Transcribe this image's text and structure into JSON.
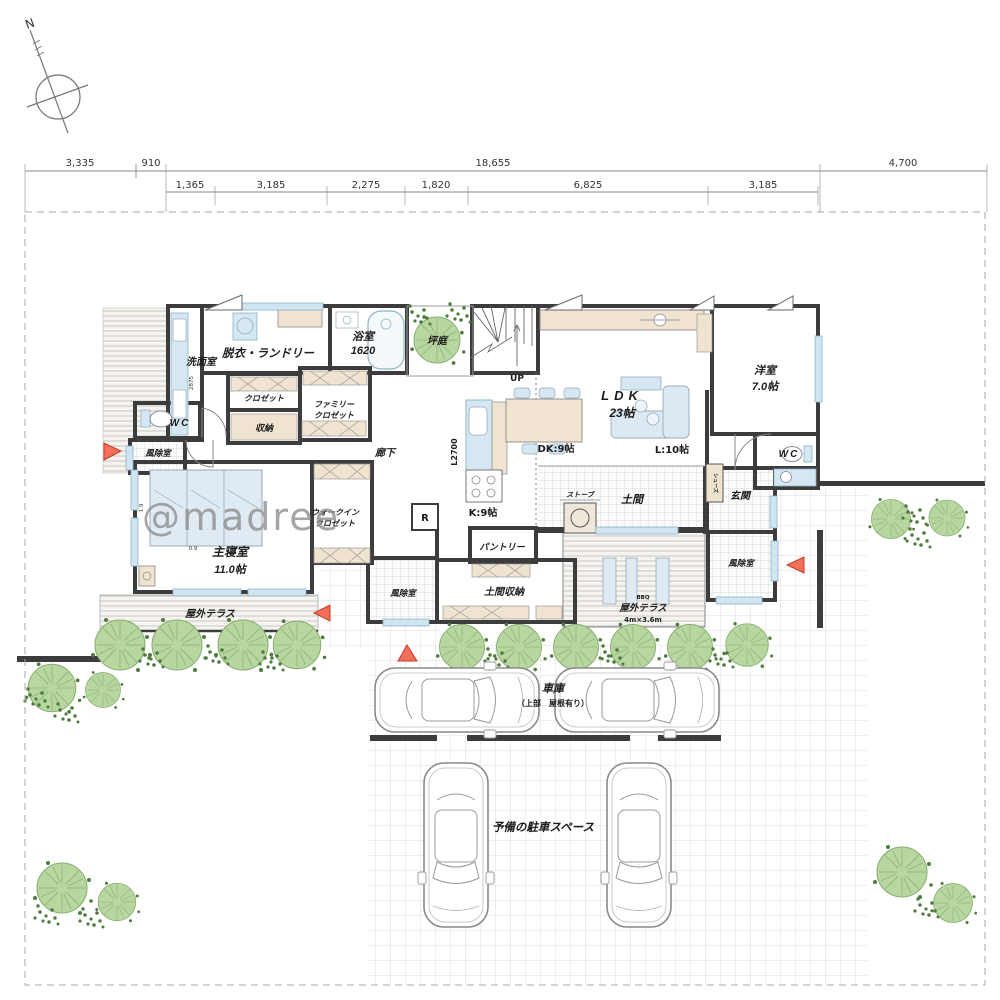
{
  "site": {
    "compass": "N",
    "watermark": "@madree",
    "dim_top": [
      "3,335",
      "910",
      "18,655",
      "4,700"
    ],
    "dim_second": [
      "1,365",
      "3,185",
      "2,275",
      "1,820",
      "6,825",
      "3,185"
    ]
  },
  "rooms": {
    "washroom": "洗面室",
    "laundry": "脱衣・ランドリー",
    "bath": "浴室",
    "bath_size": "1620",
    "courtyard": "坪庭",
    "closet": "クロゼット",
    "family_closet_1": "ファミリー",
    "storage": "収納",
    "wc": "WC",
    "windbreak": "風除室",
    "corridor": "廊下",
    "master": "主寝室",
    "master_size": "11.0帖",
    "bed_w": "1.9",
    "bed_d": "0.9",
    "wash_dim": "2875",
    "wic_1": "ウォークイン",
    "up": "UP",
    "ldk": "LDK",
    "ldk_size": "23帖",
    "dk": "DK:9帖",
    "living": "L:10帖",
    "kitchen": "K:9帖",
    "kitchen_counter": "L2700",
    "fridge": "R",
    "western": "洋室",
    "western_size": "7.0帖",
    "genkan": "玄関",
    "shoes": "シューズ",
    "doma": "土間",
    "stove": "ストーブ",
    "doma_storage": "土間収納",
    "pantry": "パントリー",
    "terrace": "屋外テラス",
    "terrace_size": "4m×3.6m",
    "bbq": "BBQ",
    "garage": "車庫",
    "garage_note": "（上部　屋根有り）",
    "spare_parking": "予備の駐車スペース"
  },
  "colors": {
    "wall": "#3c3c3c",
    "fixture_blue": "#d4e7f2",
    "wood_beige": "#f0e3d0",
    "tree_green": "#b7d6a0",
    "accent_red": "#f0705a"
  }
}
